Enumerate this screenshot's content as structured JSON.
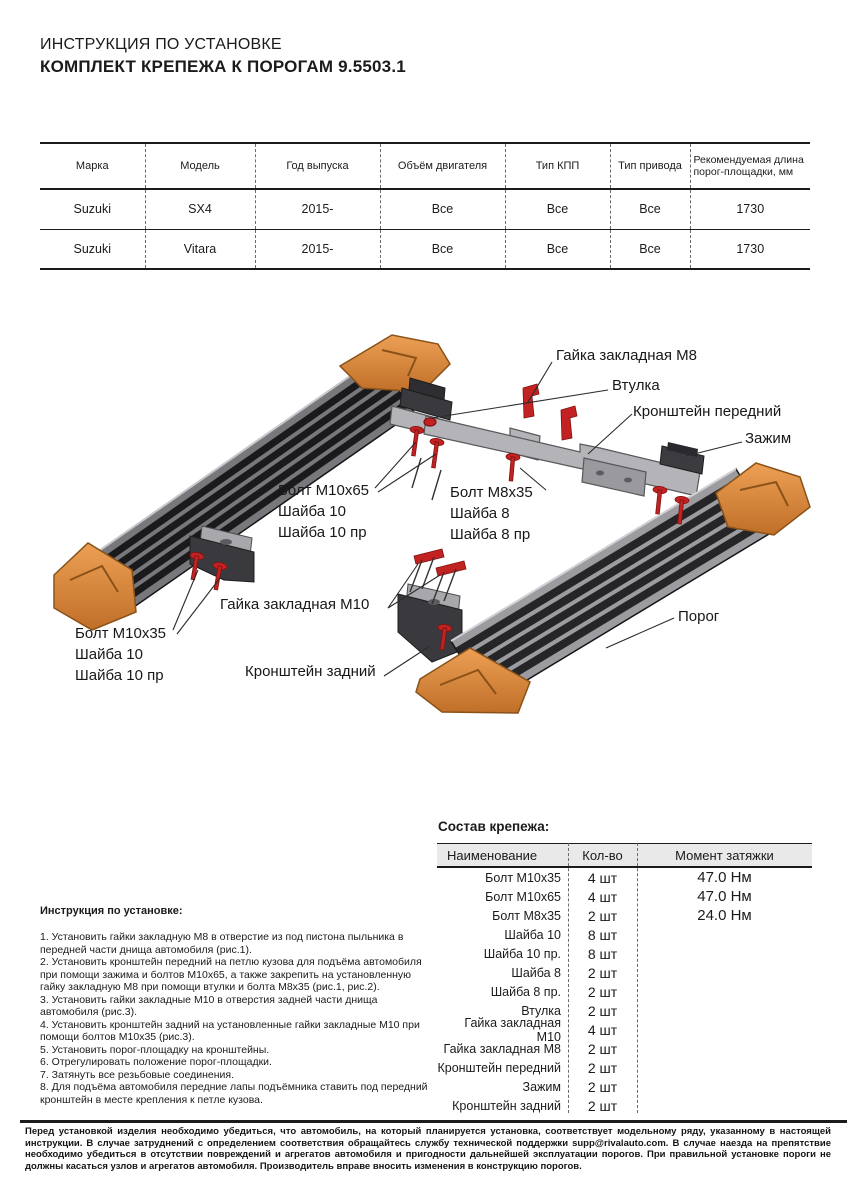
{
  "page": {
    "title_line1": "ИНСТРУКЦИЯ ПО УСТАНОВКЕ",
    "title_line2": "КОМПЛЕКТ КРЕПЕЖА К ПОРОГАМ 9.5503.1"
  },
  "vehicle_table": {
    "headers": [
      "Марка",
      "Модель",
      "Год выпуска",
      "Объём двигателя",
      "Тип КПП",
      "Тип привода",
      "Рекомендуемая длина порог-площадки, мм"
    ],
    "rows": [
      [
        "Suzuki",
        "SX4",
        "2015-",
        "Все",
        "Все",
        "Все",
        "1730"
      ],
      [
        "Suzuki",
        "Vitara",
        "2015-",
        "Все",
        "Все",
        "Все",
        "1730"
      ]
    ]
  },
  "diagram": {
    "labels": {
      "nut_m8": "Гайка закладная М8",
      "bushing": "Втулка",
      "bracket_front": "Кронштейн передний",
      "clamp": "Зажим",
      "bolt_m10x65": {
        "l1": "Болт М10х65",
        "l2": "Шайба 10",
        "l3": "Шайба 10 пр"
      },
      "bolt_m8x35": {
        "l1": "Болт М8х35",
        "l2": "Шайба 8",
        "l3": "Шайба 8 пр"
      },
      "nut_m10": "Гайка закладная М10",
      "bolt_m10x35": {
        "l1": "Болт М10х35",
        "l2": "Шайба 10",
        "l3": "Шайба 10 пр"
      },
      "bracket_rear": "Кронштейн задний",
      "board": "Порог"
    }
  },
  "instructions": {
    "heading": "Инструкция по установке:",
    "steps": [
      "1. Установить гайки закладную М8 в отверстие из под пистона пыльника в передней части днища автомобиля (рис.1).",
      "2. Установить кронштейн передний на петлю кузова для подъёма автомобиля при помощи зажима и болтов М10х65, а также закрепить на установленную гайку закладную М8 при помощи втулки и болта М8х35 (рис.1, рис.2).",
      "3. Установить гайки закладные М10 в отверстия задней части днища автомобиля (рис.3).",
      "4. Установить кронштейн задний на установленные гайки закладные М10 при помощи болтов М10х35 (рис.3).",
      "5. Установить порог-площадку на кронштейны.",
      "6. Отрегулировать положение порог-площадки.",
      "7. Затянуть все резьбовые соединения.",
      "8. Для подъёма автомобиля передние лапы подъёмника ставить под передний кронштейн в месте крепления к петле кузова."
    ]
  },
  "parts": {
    "title": "Состав крепежа:",
    "headers": [
      "Наименование",
      "Кол-во",
      "Момент затяжки"
    ],
    "rows": [
      {
        "name": "Болт М10х35",
        "qty": "4 шт",
        "torque": "47.0 Нм"
      },
      {
        "name": "Болт М10х65",
        "qty": "4 шт",
        "torque": "47.0 Нм"
      },
      {
        "name": "Болт М8х35",
        "qty": "2 шт",
        "torque": "24.0 Нм"
      },
      {
        "name": "Шайба 10",
        "qty": "8 шт",
        "torque": ""
      },
      {
        "name": "Шайба 10 пр.",
        "qty": "8 шт",
        "torque": ""
      },
      {
        "name": "Шайба 8",
        "qty": "2 шт",
        "torque": ""
      },
      {
        "name": "Шайба 8 пр.",
        "qty": "2 шт",
        "torque": ""
      },
      {
        "name": "Втулка",
        "qty": "2 шт",
        "torque": ""
      },
      {
        "name": "Гайка закладная М10",
        "qty": "4 шт",
        "torque": ""
      },
      {
        "name": "Гайка закладная М8",
        "qty": "2 шт",
        "torque": ""
      },
      {
        "name": "Кронштейн передний",
        "qty": "2 шт",
        "torque": ""
      },
      {
        "name": "Зажим",
        "qty": "2 шт",
        "torque": ""
      },
      {
        "name": "Кронштейн задний",
        "qty": "2 шт",
        "torque": ""
      }
    ]
  },
  "footer": {
    "text": "Перед установкой изделия необходимо убедиться, что автомобиль, на который планируется установка, соответствует модельному ряду, указанному в настоящей инструкции. В случае затруднений с определением соответствия обращайтесь службу технической поддержки supp@rivalauto.com. В случае наезда на препятствие необходимо убедиться в отсутствии повреждений и агрегатов автомобиля и пригодности дальнейшей эксплуатации порогов. При правильной установке пороги не должны касаться узлов и агрегатов автомобиля. Производитель вправе вносить изменения в конструкцию порогов."
  },
  "colors": {
    "accent_orange": "#dd8a3f",
    "fastener_red": "#c22222",
    "table_header_bg": "#e9e9e9",
    "text": "#1b1b1b"
  }
}
